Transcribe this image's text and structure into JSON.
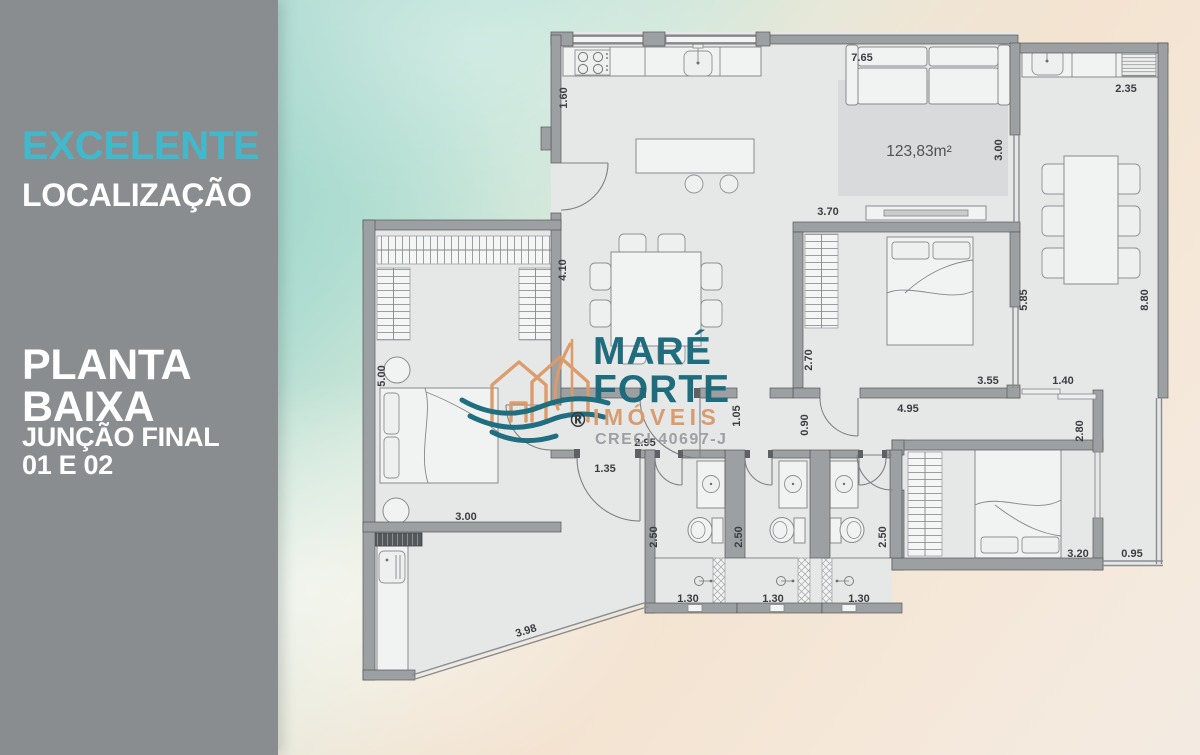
{
  "sidebar": {
    "headline_accent": "EXCELENTE",
    "headline": "LOCALIZAÇÃO",
    "title_line1": "PLANTA",
    "title_line2": "BAIXA",
    "subtitle_line1": "JUNÇÃO FINAL",
    "subtitle_line2": "01 E 02",
    "accent_color": "#41b9cd",
    "bg_color": "#8a8d8f"
  },
  "logo": {
    "name_line1": "MARÉ",
    "name_line2": "FORTE",
    "subtitle": "IMÓVEIS",
    "registered_mark": "®",
    "license": "CRECI 40697-J",
    "teal": "#19697a",
    "orange": "#d79a6c",
    "gray": "#9b9ea0"
  },
  "plan": {
    "area_label": "123,83m²",
    "wall_color": "#9da0a2",
    "floor_color": "#e6e8e8",
    "dimensions": [
      {
        "value": "1.60",
        "x": 567,
        "y": 98,
        "rot": -90
      },
      {
        "value": "7.65",
        "x": 862,
        "y": 61,
        "rot": 0
      },
      {
        "value": "2.35",
        "x": 1126,
        "y": 92,
        "rot": 0
      },
      {
        "value": "3.00",
        "x": 1002,
        "y": 150,
        "rot": -90
      },
      {
        "value": "3.70",
        "x": 828,
        "y": 215,
        "rot": 0
      },
      {
        "value": "4.10",
        "x": 566,
        "y": 270,
        "rot": -90
      },
      {
        "value": "5.85",
        "x": 1027,
        "y": 300,
        "rot": -90
      },
      {
        "value": "8.80",
        "x": 1148,
        "y": 300,
        "rot": -90
      },
      {
        "value": "5.00",
        "x": 385,
        "y": 376,
        "rot": -90
      },
      {
        "value": "2.70",
        "x": 812,
        "y": 360,
        "rot": -90
      },
      {
        "value": "3.55",
        "x": 988,
        "y": 384,
        "rot": 0
      },
      {
        "value": "1.40",
        "x": 1063,
        "y": 384,
        "rot": 0
      },
      {
        "value": "4.95",
        "x": 908,
        "y": 412,
        "rot": 0
      },
      {
        "value": "1.05",
        "x": 740,
        "y": 416,
        "rot": -90
      },
      {
        "value": "0.90",
        "x": 808,
        "y": 425,
        "rot": -90
      },
      {
        "value": "2.80",
        "x": 1083,
        "y": 431,
        "rot": -90
      },
      {
        "value": "2.95",
        "x": 645,
        "y": 446,
        "rot": 0
      },
      {
        "value": "1.35",
        "x": 605,
        "y": 472,
        "rot": 0
      },
      {
        "value": "3.00",
        "x": 466,
        "y": 520,
        "rot": 0
      },
      {
        "value": "2.50",
        "x": 657,
        "y": 537,
        "rot": -90
      },
      {
        "value": "2.50",
        "x": 742,
        "y": 537,
        "rot": -90
      },
      {
        "value": "2.50",
        "x": 886,
        "y": 537,
        "rot": -90
      },
      {
        "value": "3.20",
        "x": 1078,
        "y": 557,
        "rot": 0
      },
      {
        "value": "0.95",
        "x": 1132,
        "y": 557,
        "rot": 0
      },
      {
        "value": "1.30",
        "x": 688,
        "y": 602,
        "rot": 0
      },
      {
        "value": "1.30",
        "x": 773,
        "y": 602,
        "rot": 0
      },
      {
        "value": "1.30",
        "x": 859,
        "y": 602,
        "rot": 0
      },
      {
        "value": "3.98",
        "x": 527,
        "y": 634,
        "rot": -17
      }
    ]
  }
}
